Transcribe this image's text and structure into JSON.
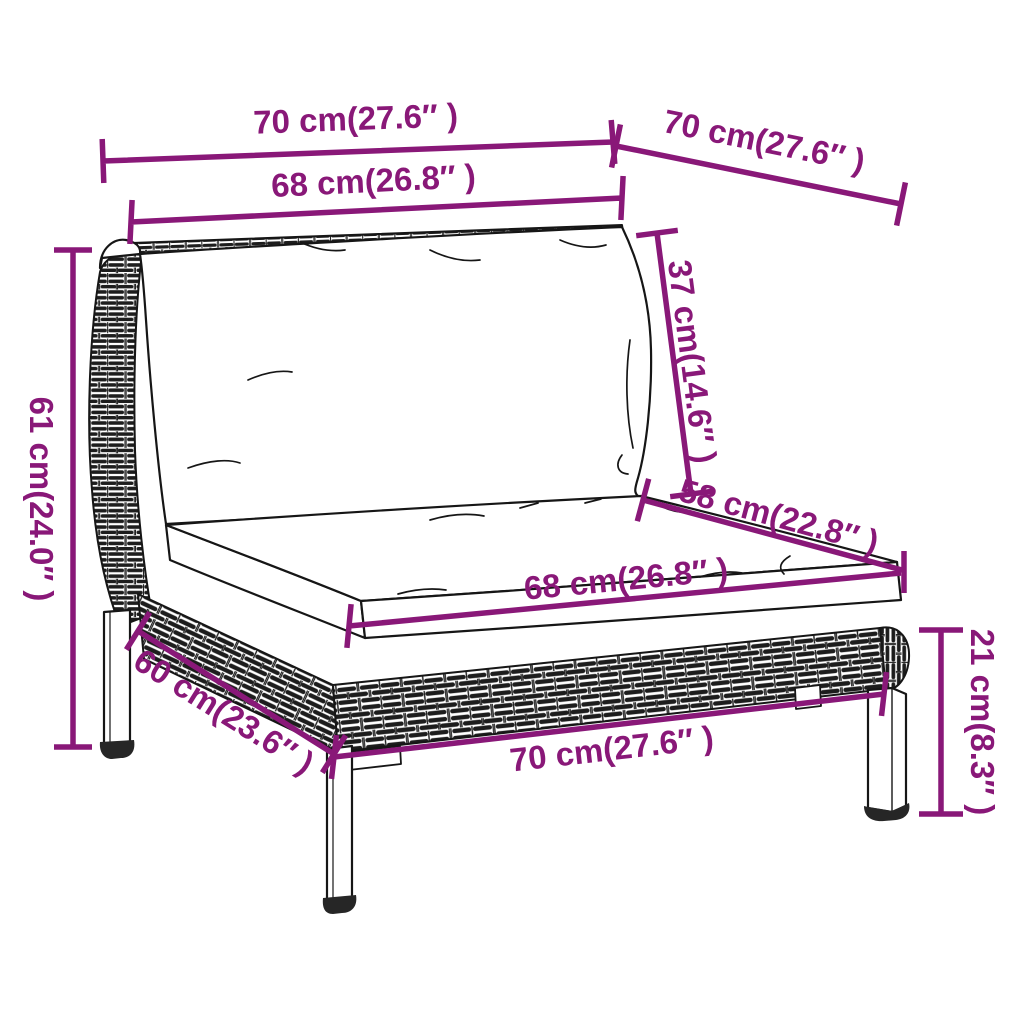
{
  "figure": {
    "subject": "poly rattan garden sofa middle section — dimension line drawing",
    "background": "#ffffff"
  },
  "colors": {
    "dimension_annotation": "#891878",
    "line_art": "#161616"
  },
  "dimensions": [
    {
      "id": "top-width",
      "label": "70 cm(27.6″ )"
    },
    {
      "id": "top-depth",
      "label": "70 cm(27.6″ )"
    },
    {
      "id": "backrest-width",
      "label": "68 cm(26.8″ )"
    },
    {
      "id": "back-cushion-height",
      "label": "37 cm(14.6″ )"
    },
    {
      "id": "seat-depth",
      "label": "58 cm(22.8″ )"
    },
    {
      "id": "overall-height",
      "label": "61 cm(24.0″ )"
    },
    {
      "id": "seat-width",
      "label": "68 cm(26.8″ )"
    },
    {
      "id": "base-depth",
      "label": "60 cm(23.6″ )"
    },
    {
      "id": "base-width",
      "label": "70 cm(27.6″ )"
    },
    {
      "id": "leg-height",
      "label": "21 cm(8.3″ )"
    }
  ]
}
